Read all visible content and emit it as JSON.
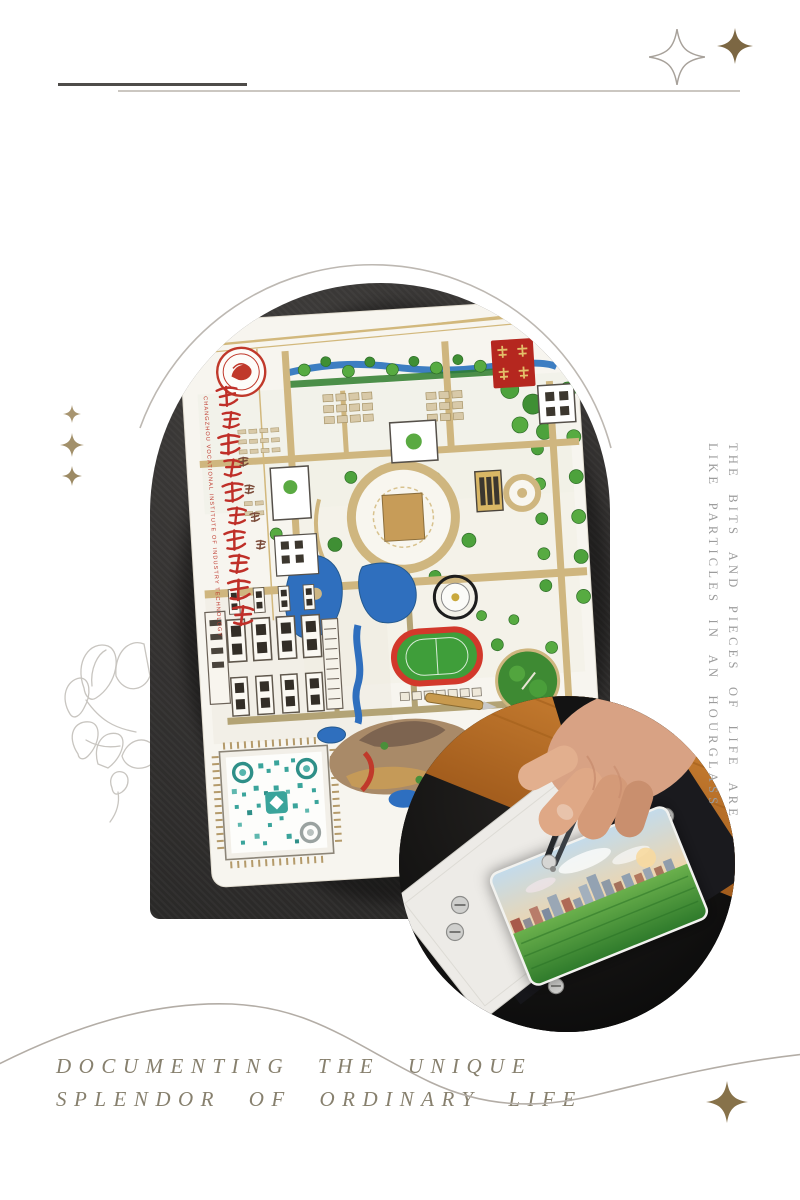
{
  "poster": {
    "right_caption": {
      "line1": "THE BITS AND PIECES OF LIFE ARE",
      "line2": "LIKE PARTICLES IN AN HOURGLASS"
    },
    "bottom_caption": {
      "line1": "DOCUMENTING THE UNIQUE",
      "line2": "SPLENDOR OF ORDINARY LIFE"
    },
    "map_card": {
      "title_cn": "常州工业职业技术学院",
      "title_en": "CHANGZHOU VOCATIONAL INSTITUTE OF INDUSTRY TECHNOLOGY"
    },
    "colors": {
      "accent_gold": "#7c6743",
      "soft_gold": "#a2906a",
      "line_gray": "#bdb8b2",
      "caption_gray": "#9c9c9c",
      "caption_brown": "#87806e",
      "seal_red": "#b5271f",
      "map_road_gold": "#cfb67f",
      "qr_teal": "#3aa49b"
    }
  }
}
